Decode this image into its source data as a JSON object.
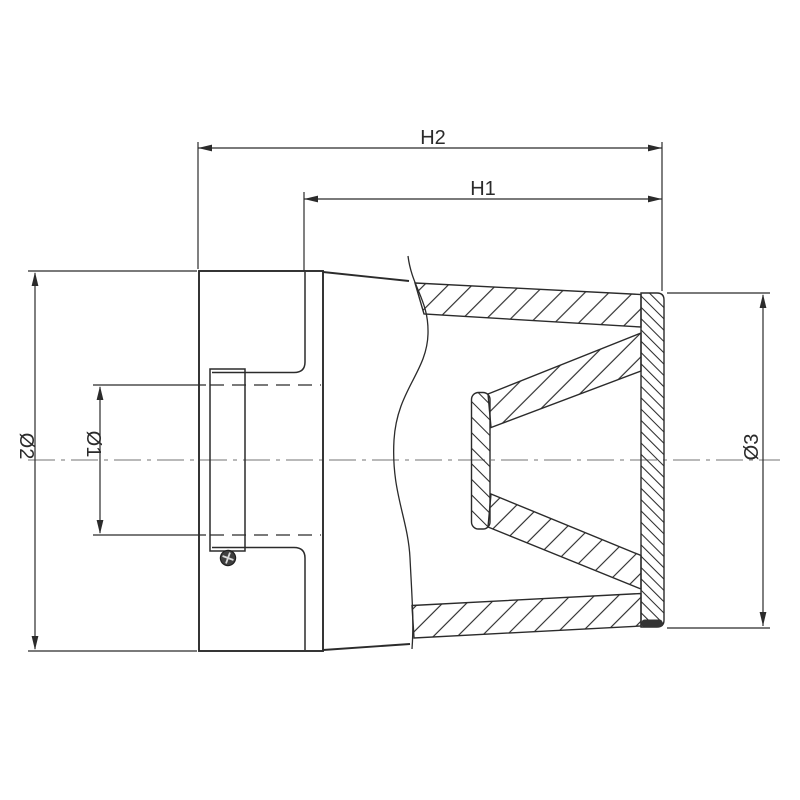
{
  "drawing": {
    "kind": "cross-section technical drawing",
    "labels": {
      "h2": "H2",
      "h1": "H1",
      "d2": "Ø2",
      "d1": "Ø1",
      "d3": "Ø3"
    },
    "colors": {
      "background": "#ffffff",
      "line": "#2b2b2b",
      "centerline": "#8f8f8f",
      "screw_fill": "#3f3f3f",
      "screw_cross": "#d9d9d9",
      "end_cap_base": "#333333"
    }
  }
}
